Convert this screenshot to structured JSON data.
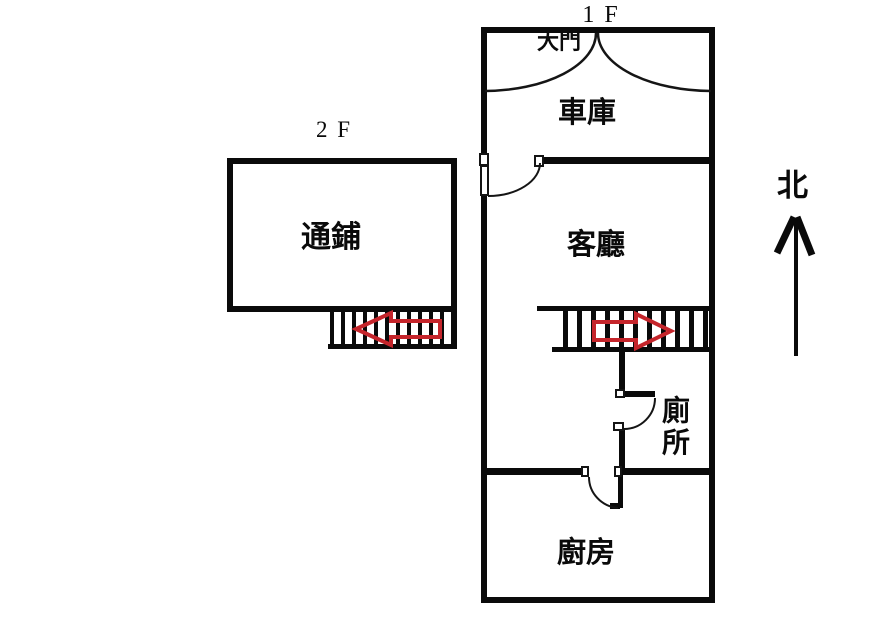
{
  "diagram_title": "house floor plan",
  "colors": {
    "wall": "#0a0a0a",
    "arrow_red": "#c5252b",
    "background": "#ffffff"
  },
  "floor1": {
    "label": "1 F",
    "rooms": {
      "main_door": "大門",
      "garage": "車庫",
      "living_room": "客廳",
      "toilet": "廁所",
      "kitchen": "廚房"
    }
  },
  "floor2": {
    "label": "2 F",
    "rooms": {
      "sleeping_area": "通鋪"
    }
  },
  "compass": {
    "label": "北",
    "icon": "up-arrow"
  },
  "stairs": {
    "floor1": {
      "tread_count": 11,
      "arrow_icon": "red-right-arrow"
    },
    "floor2": {
      "tread_count": 11,
      "arrow_icon": "red-left-arrow"
    }
  }
}
